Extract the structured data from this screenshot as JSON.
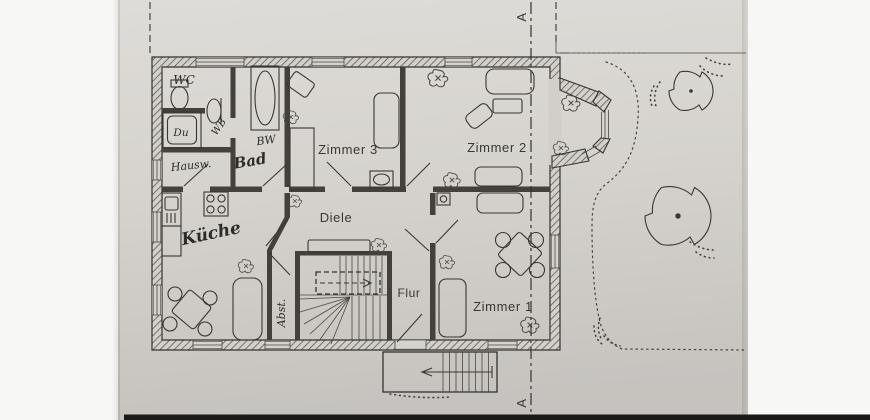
{
  "document": {
    "kind": "scanned architectural floor plan photo",
    "colors": {
      "paper": "#d6d3ce",
      "ink": "#35332f",
      "photo_margin": "#f7f7f6",
      "bottom_edge": "#1b1a18"
    }
  },
  "labels": {
    "zimmer1": "Zimmer 1",
    "zimmer2": "Zimmer 2",
    "zimmer3": "Zimmer 3",
    "diele": "Diele",
    "flur": "Flur",
    "kueche": "Küche",
    "bad": "Bad",
    "wc": "WC",
    "du": "Du",
    "wb": "WB",
    "bw": "BW",
    "hausw": "Hausw.",
    "abst": "Abst.",
    "section_top": "A",
    "section_bottom": "A"
  }
}
